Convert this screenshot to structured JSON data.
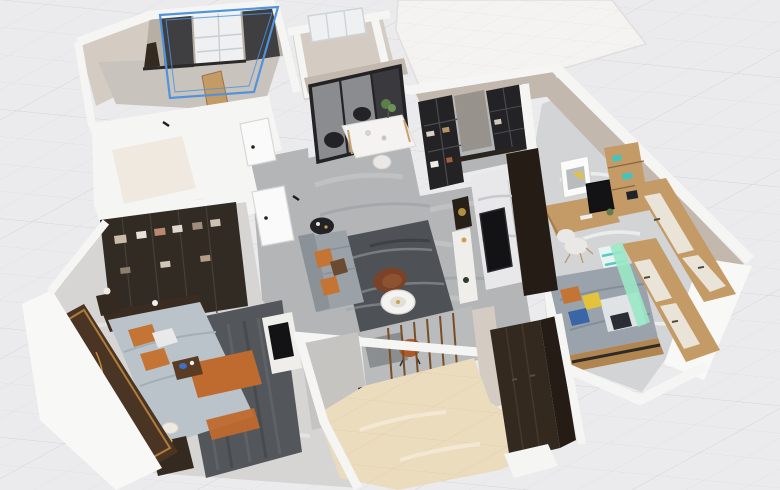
{
  "app": {
    "view_label": "3d-floor-plan-view",
    "background": "#ebebed"
  },
  "selection": {
    "selected_object": "small-bedroom-window-wall",
    "color": "#4f93dd",
    "style": "double-outline-box"
  },
  "colors": {
    "bg": "#ebebed",
    "gridminor": "#dcdce0",
    "gridmajor": "#d1d1d6",
    "tileline": "#e6e5e3",
    "creamline": "#ddcdab",
    "wallwhite": "#f5f5f4",
    "wallbright": "#f8f8f7",
    "wallshadow": "#d9d8d5",
    "beige": "#c2b8ad",
    "beigelight": "#d4ccc2",
    "taupe": "#b7aea4",
    "floorgray": "#b3b5b7",
    "floormarble": "#d6d5d3",
    "flooroffice": "#d3d4d6",
    "floorcream": "#ecdcbe",
    "floortile": "#f4f3f1",
    "floorbath": "#efe9df",
    "floorb2": "#c8c3bd",
    "blue": "#4f93dd",
    "curtain": "#3f3e41",
    "windowwhite": "#eef0f2",
    "glass": "#8a8c8f",
    "glassdark": "#3a3a3e",
    "framedark": "#232326",
    "wooddark": "#352a20",
    "wooddarkest": "#241c15",
    "woodmid": "#c49a66",
    "woodwarm": "#b08550",
    "wardark": "#262019",
    "ruglive": "#4e5256",
    "rugbed": "#53575b",
    "sofa": "#9aa2a8",
    "orange": "#c47434",
    "leather": "#7a4226",
    "tablewhite": "#f4f3f1",
    "chairblack": "#232327",
    "chairwhite": "#e9e8e6",
    "green": "#5d7d4b",
    "marblepanel": "#e8e8ea",
    "tv": "#131316",
    "duvet": "#b9c3c9",
    "runner": "#bf6a2e",
    "headboard": "#3a2c20",
    "artbase": "#4a3424",
    "artgold": "#c98f3e",
    "kidsblanket": "#9aa3ab",
    "yellow": "#e3c23c",
    "bluepillow": "#3a66a8",
    "teal": "#44c4be",
    "mint": "#9ae8c6",
    "doorwhite": "#fafafa",
    "threshold": "#1c1c1e",
    "panelbeige": "#e9e3d8",
    "graypanel": "#97928b",
    "consolewhite": "#efeeea",
    "gold": "#c9a24a",
    "graypillar": "#c6c4c0",
    "slat": "#7a4e26"
  },
  "scene": {
    "type": "3d-floor-plan",
    "rooms": [
      {
        "id": "small-bedroom",
        "furniture": [
          "dark-curtains",
          "white-window",
          "wood-cabinet",
          "floor-lamp"
        ],
        "note": "window wall selected in blue"
      },
      {
        "id": "balcony",
        "furniture": [
          "white-window"
        ]
      },
      {
        "id": "dining-room",
        "furniture": [
          "marble-dining-table",
          "black-chair",
          "black-chair",
          "white-chair",
          "potted-plant",
          "glass-sliding-door"
        ]
      },
      {
        "id": "entry-hall",
        "furniture": [
          "glass-display-cabinet",
          "gray-wall-panel",
          "dark-bookcase"
        ]
      },
      {
        "id": "living-room",
        "furniture": [
          "gray-sofa",
          "orange-pillows",
          "leather-armchair",
          "round-coffee-table",
          "black-side-table",
          "dark-rug",
          "tv-marble-wall",
          "tv",
          "console-decor"
        ]
      },
      {
        "id": "office",
        "furniture": [
          "wall-picture",
          "wood-desk",
          "monitor",
          "white-chair",
          "wood-shelf",
          "teal-drawer-unit",
          "white-door-wardrobe"
        ]
      },
      {
        "id": "kids-bedroom",
        "furniture": [
          "bed-gray-blanket",
          "orange-pillow",
          "yellow-pillow",
          "blue-pillow",
          "wood-wardrobe-back",
          "mint-light-shelf"
        ]
      },
      {
        "id": "master-bedroom",
        "furniture": [
          "double-bed",
          "orange-runner",
          "orange-pillows",
          "dark-headboard",
          "gold-art-wall",
          "nightstand-lamp",
          "dark-glass-wardrobe",
          "dark-rug",
          "tv-stand"
        ]
      },
      {
        "id": "bathroom-1",
        "furniture": [
          "white-door"
        ]
      },
      {
        "id": "bathroom-2",
        "furniture": [
          "white-door"
        ]
      },
      {
        "id": "utility-room-cream-tile",
        "furniture": [
          "slat-partition-niche",
          "orange-desk-chair",
          "black-marble-threshold",
          "tall-dark-wardrobe"
        ]
      },
      {
        "id": "terrace",
        "furniture": []
      }
    ]
  }
}
